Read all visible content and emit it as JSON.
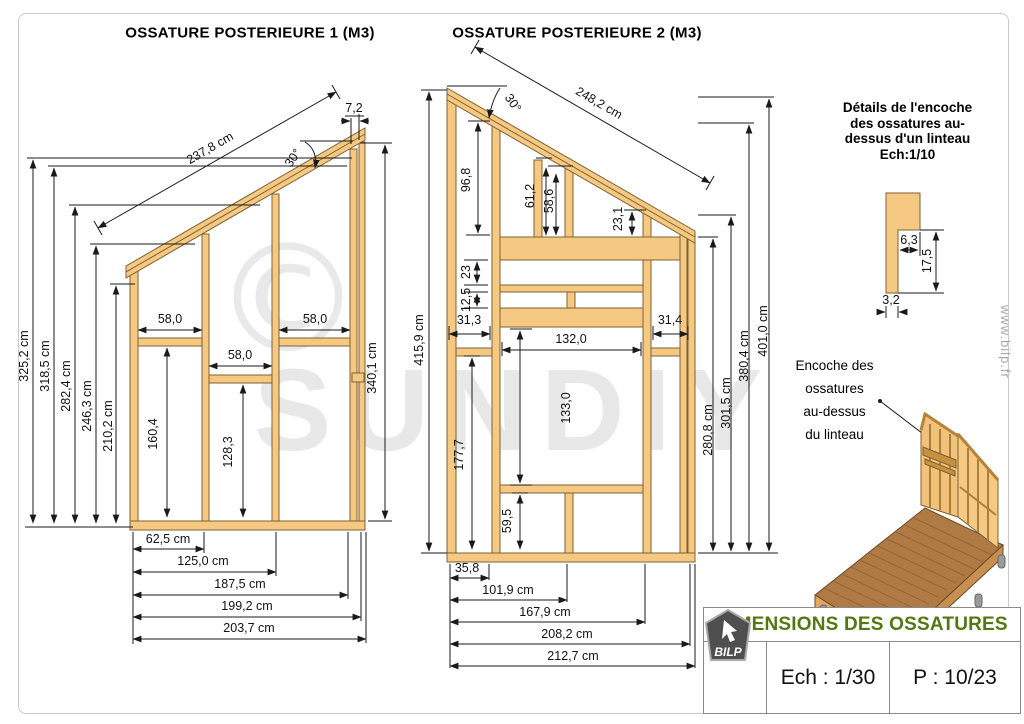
{
  "frame1": {
    "title": "OSSATURE POSTERIEURE 1 (M3)",
    "slope_length": "237,8 cm",
    "angle": "30°",
    "cap_width": "7,2",
    "right_height": "340,1 cm",
    "left_heights": [
      "325,2 cm",
      "318,5 cm",
      "282,4 cm",
      "246,3 cm",
      "210,2 cm"
    ],
    "bay_widths": [
      "58,0",
      "58,0",
      "58,0"
    ],
    "left_bay_height": "160,4",
    "mid_bay_height": "128,3",
    "bottom_widths": [
      "62,5 cm",
      "125,0 cm",
      "187,5 cm",
      "199,2 cm",
      "203,7 cm"
    ]
  },
  "frame2": {
    "title": "OSSATURE POSTERIEURE 2 (M3)",
    "slope_length": "248,2 cm",
    "angle": "30°",
    "left_height": "415,9 cm",
    "stud_heights": [
      "96,8",
      "61,2",
      "58,6",
      "23,1"
    ],
    "gaps": [
      "23",
      "12,5"
    ],
    "bay_widths": [
      "31,3",
      "31,4"
    ],
    "opening_width": "132,0",
    "opening_height": "133,0",
    "left_lower_height": "177,7",
    "sill_height": "59,5",
    "right_heights": [
      "280,8 cm",
      "301,5 cm",
      "380,4 cm",
      "401,0 cm"
    ],
    "bottom_widths": [
      "35,8",
      "101,9 cm",
      "167,9 cm",
      "208,2 cm",
      "212,7 cm"
    ]
  },
  "detail": {
    "title_lines": [
      "Détails de l'encoche",
      "des ossatures au-",
      "dessus d'un linteau",
      "Ech:1/10"
    ],
    "notch_width": "6,3",
    "notch_height": "17,5",
    "stud_thickness": "3,2"
  },
  "callout": {
    "lines": [
      "Encoche des",
      "ossatures",
      "au-dessus",
      "du linteau"
    ]
  },
  "watermarks": {
    "copyright": "©",
    "brand": "SUNDIY",
    "site": "www.bilp.fr"
  },
  "titleblock": {
    "title": "DIMENSIONS DES OSSATURES",
    "title_color": "#55770f",
    "logo_text": "BILP",
    "scale_label": "Ech : 1/30",
    "page_label": "P : 10/23"
  },
  "colors": {
    "wood_fill": "#f6c983",
    "wood_stroke": "#7d6133",
    "dim_line": "#1a1a1a"
  }
}
